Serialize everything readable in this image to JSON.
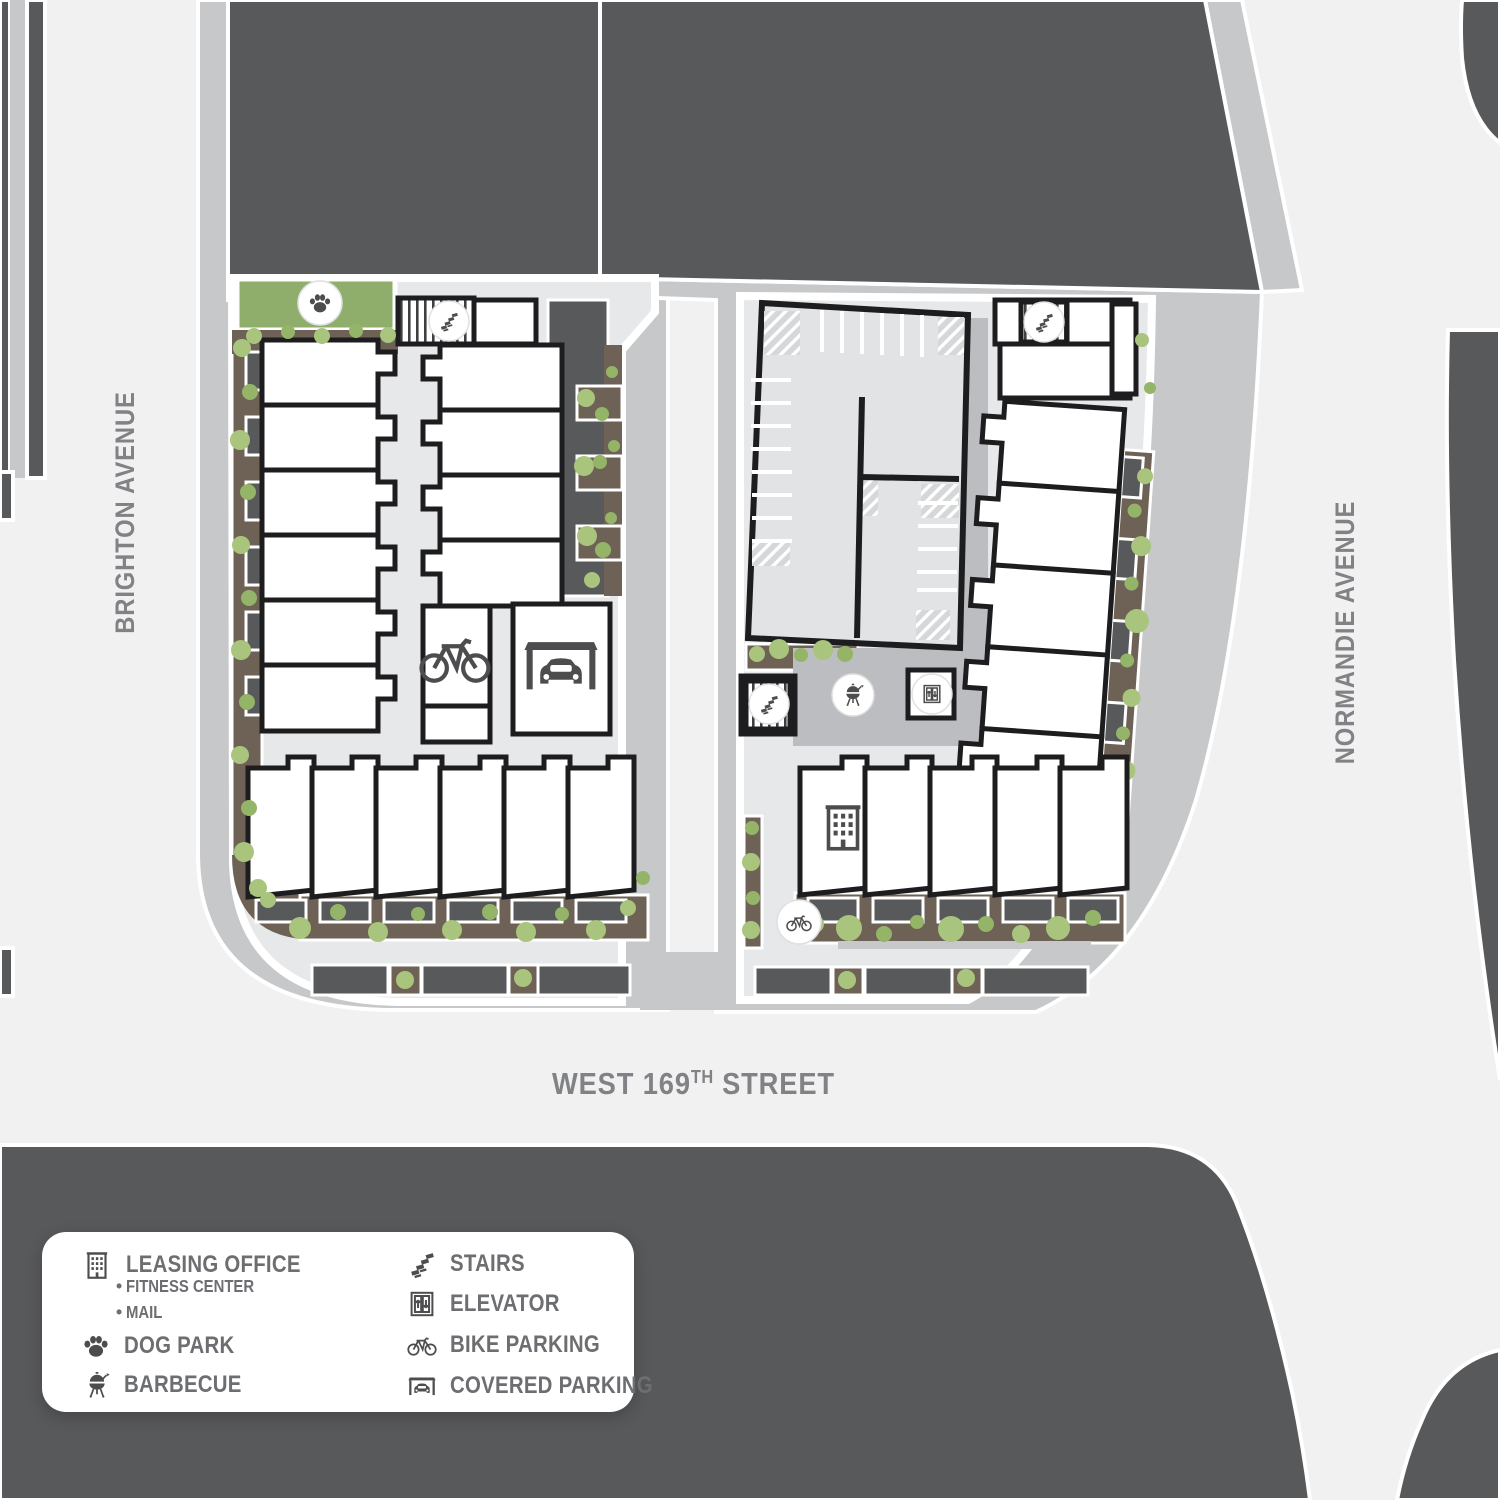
{
  "streets": {
    "brighton": "BRIGHTON AVENUE",
    "normandie": "NORMANDIE AVENUE",
    "west_169th": {
      "base": "WEST 169",
      "superscript": "TH",
      "rest": " STREET"
    }
  },
  "legend": {
    "bullet": "•",
    "columns": {
      "left": [
        {
          "icon": "leasing-office-icon",
          "label": "LEASING OFFICE",
          "sublabels": [
            "FITNESS CENTER",
            "MAIL"
          ]
        },
        {
          "icon": "dog-park-icon",
          "label": "DOG PARK"
        },
        {
          "icon": "barbecue-icon",
          "label": "BARBECUE"
        }
      ],
      "right": [
        {
          "icon": "stairs-icon",
          "label": "STAIRS"
        },
        {
          "icon": "elevator-icon",
          "label": "ELEVATOR"
        },
        {
          "icon": "bike-parking-icon",
          "label": "BIKE PARKING"
        },
        {
          "icon": "covered-parking-icon",
          "label": "COVERED PARKING"
        }
      ]
    }
  },
  "map_icons": [
    {
      "type": "dog-park"
    },
    {
      "type": "stairs"
    },
    {
      "type": "bike-parking"
    },
    {
      "type": "covered-parking"
    },
    {
      "type": "stairs"
    },
    {
      "type": "barbecue"
    },
    {
      "type": "elevator"
    },
    {
      "type": "stairs"
    },
    {
      "type": "leasing-office"
    },
    {
      "type": "bike-parking"
    }
  ],
  "palette": {
    "street": "#f1f1f2",
    "sidewalk": "#c7c8ca",
    "block_dark": "#58595b",
    "paving": "#e7e8e9",
    "courtyard": "#bcbdc0",
    "parking_surface": "#e2e3e4",
    "planter": "#6e6156",
    "patio": "#58595b",
    "bush": "#a9c57d",
    "bush_dark": "#94b468",
    "dog_park_green": "#8fae6c",
    "building_fill": "#ffffff",
    "outline": "#1d1d1f",
    "icon": "#4d4d4f",
    "street_label": "#808285",
    "legend_text": "#6d6e71",
    "legend_bg": "#ffffff"
  }
}
